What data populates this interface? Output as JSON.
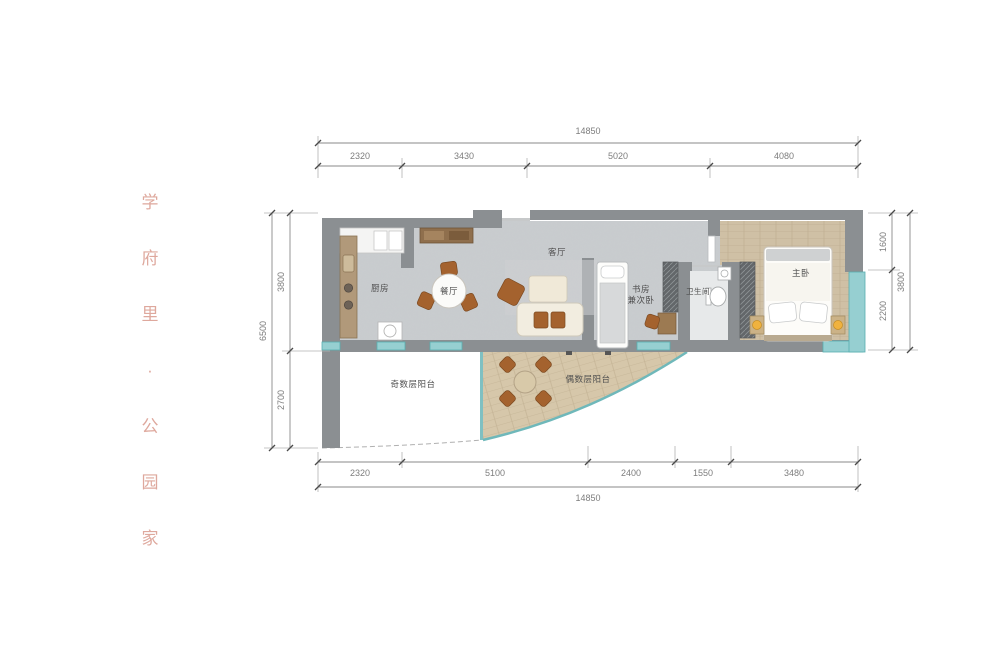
{
  "watermark": {
    "chars": [
      "学",
      "府",
      "里",
      "·",
      "公",
      "园",
      "家"
    ],
    "color": "#dca195"
  },
  "floorplan": {
    "rooms": {
      "kitchen": "厨房",
      "dining": "餐厅",
      "living": "客厅",
      "study_line1": "书房",
      "study_line2": "兼次卧",
      "bathroom": "卫生间",
      "master": "主卧",
      "balcony_odd": "奇数层阳台",
      "balcony_even": "偶数层阳台"
    },
    "colors": {
      "wall": "#8b8f92",
      "floor": "#c9cccf",
      "wood": "#cfc0a5",
      "window": "#96cfd1",
      "chair": "#a4622e"
    }
  },
  "dimensions": {
    "top": {
      "total": "14850",
      "segments": [
        "2320",
        "3430",
        "5020",
        "4080"
      ]
    },
    "bottom": {
      "total": "14850",
      "segments": [
        "2320",
        "5100",
        "2400",
        "1550",
        "3480"
      ]
    },
    "left": {
      "total": "6500",
      "segments": [
        "3800",
        "2700"
      ]
    },
    "right": {
      "total": "3800",
      "segments": [
        "1600",
        "2200"
      ]
    }
  }
}
